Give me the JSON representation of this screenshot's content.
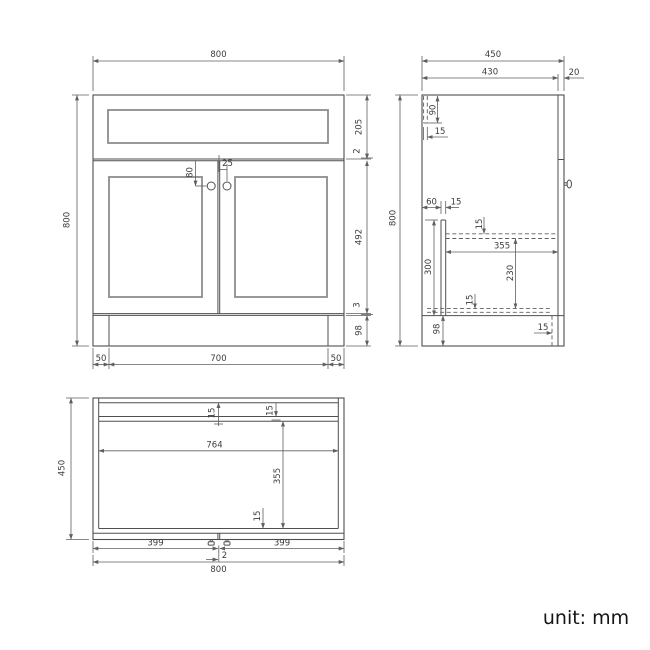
{
  "colors": {
    "line": "#4f4f4f",
    "panel_line": "#8c8c8c",
    "background": "#ffffff"
  },
  "front": {
    "width": "800",
    "height": "800",
    "drawer_h": "205",
    "gap_top": "2",
    "door_h": "492",
    "gap_bottom": "3",
    "plinth_h": "98",
    "inset_left": "50",
    "plinth_w": "700",
    "inset_right": "50",
    "knob_v": "80",
    "knob_h": "25"
  },
  "side": {
    "depth": "450",
    "body_depth": "430",
    "door_t": "20",
    "height": "800",
    "rail_h": "90",
    "back_t": "15",
    "rail_off": "60",
    "rail_t": "15",
    "shelf_t": "15",
    "shelf_d": "355",
    "shelf_bot": "230",
    "support_h": "300",
    "bottom_t": "15",
    "plinth_h": "98",
    "plinth_rec": "15"
  },
  "plan": {
    "depth": "450",
    "back_t": "15",
    "rail_t": "15",
    "inner_w": "764",
    "inner_d": "355",
    "front_t": "15",
    "door_left": "399",
    "door_gap": "2",
    "door_right": "399",
    "width": "800"
  },
  "note": {
    "unit": "unit: mm"
  }
}
